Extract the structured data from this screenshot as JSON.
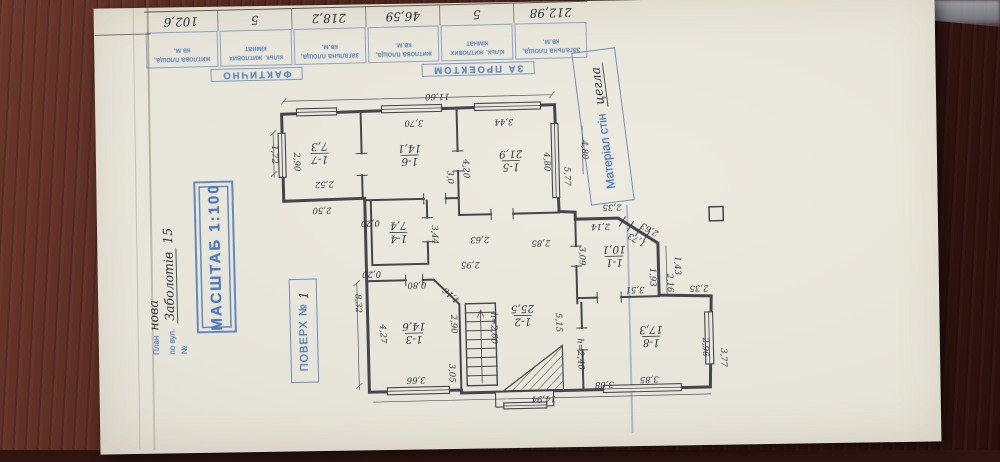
{
  "table": {
    "groups": [
      {
        "label": "ЗА ПРОЕКТОМ"
      },
      {
        "label": "ФАКТИЧНО"
      }
    ],
    "cells": [
      {
        "header": "загальна площа, кв.м.",
        "value": "212,98"
      },
      {
        "header": "кільк. житлових кімнат",
        "value": "5"
      },
      {
        "header": "житлова площа, кв.м.",
        "value": "46,59"
      },
      {
        "header": "загальна площа, кв.м.",
        "value": "218,2"
      },
      {
        "header": "кільк. житлових кімнат",
        "value": "5"
      },
      {
        "header": "житлова площа, кв.м.",
        "value": "102,6"
      }
    ]
  },
  "stamps": {
    "scale_label": "МАСШТАБ 1:100",
    "floor_label": "ПОВЕРХ №",
    "floor_value": "1",
    "material_label": "Матеріал стін",
    "material_value": "цегла",
    "address": {
      "l1": "План",
      "v1": "нова",
      "l2": "по вул.",
      "v2": "Заболотів",
      "l3": "№",
      "v3": "15"
    }
  },
  "plan": {
    "rooms": [
      {
        "number": "1-7",
        "area": "7,3",
        "x": 322,
        "y": 149
      },
      {
        "number": "1-6",
        "area": "14,1",
        "x": 412,
        "y": 153
      },
      {
        "number": "1-5",
        "area": "21,9",
        "x": 513,
        "y": 161
      },
      {
        "number": "1-4",
        "area": "7,4",
        "x": 399,
        "y": 230
      },
      {
        "number": "1-3",
        "area": "14,6",
        "x": 412,
        "y": 331
      },
      {
        "number": "1-2",
        "area": "25,5",
        "x": 521,
        "y": 316
      },
      {
        "number": "1-1",
        "area": "10,1",
        "x": 614,
        "y": 259
      },
      {
        "number": "1-8",
        "area": "17,3",
        "x": 649,
        "y": 340
      }
    ],
    "dimensions": [
      {
        "t": "11,60",
        "x": 441,
        "y": 95,
        "r": 180
      },
      {
        "t": "3,70",
        "x": 417,
        "y": 121,
        "r": 180
      },
      {
        "t": "3,44",
        "x": 507,
        "y": 122,
        "r": 180
      },
      {
        "t": "4,20",
        "x": 468,
        "y": 168,
        "r": 90
      },
      {
        "t": "4,80",
        "x": 549,
        "y": 163,
        "r": 90
      },
      {
        "t": "5,77",
        "x": 569,
        "y": 178,
        "r": 90
      },
      {
        "t": "4,80",
        "x": 587,
        "y": 152,
        "r": 90
      },
      {
        "t": "1,72",
        "x": 277,
        "y": 149,
        "r": 90
      },
      {
        "t": "2,90",
        "x": 299,
        "y": 157,
        "r": 90
      },
      {
        "t": "2,52",
        "x": 326,
        "y": 180,
        "r": 180
      },
      {
        "t": "2,50",
        "x": 323,
        "y": 206,
        "r": 180
      },
      {
        "t": "3,0",
        "x": 452,
        "y": 176,
        "r": 90
      },
      {
        "t": "0,20",
        "x": 371,
        "y": 220,
        "r": 180
      },
      {
        "t": "0,20",
        "x": 371,
        "y": 271,
        "r": 180
      },
      {
        "t": "3,44",
        "x": 435,
        "y": 233,
        "r": 90
      },
      {
        "t": "2,63",
        "x": 480,
        "y": 239,
        "r": 180
      },
      {
        "t": "2,95",
        "x": 470,
        "y": 264,
        "r": 180
      },
      {
        "t": "0,80",
        "x": 416,
        "y": 283,
        "r": 180
      },
      {
        "t": "1,16",
        "x": 450,
        "y": 294,
        "r": 225
      },
      {
        "t": "4,27",
        "x": 381,
        "y": 331,
        "r": 90
      },
      {
        "t": "2,90",
        "x": 452,
        "y": 323,
        "r": 90
      },
      {
        "t": "3,66",
        "x": 413,
        "y": 378,
        "r": 180
      },
      {
        "t": "8,32",
        "x": 357,
        "y": 300,
        "r": 90
      },
      {
        "t": "3,05",
        "x": 449,
        "y": 372,
        "r": 90
      },
      {
        "t": "h=2,60",
        "x": 492,
        "y": 328,
        "r": 90
      },
      {
        "t": "14,94",
        "x": 540,
        "y": 400,
        "r": 180
      },
      {
        "t": "2,85",
        "x": 541,
        "y": 244,
        "r": 180
      },
      {
        "t": "2,14",
        "x": 601,
        "y": 229,
        "r": 180
      },
      {
        "t": "2,35",
        "x": 613,
        "y": 210,
        "r": 180
      },
      {
        "t": "2,63",
        "x": 650,
        "y": 233,
        "r": 212
      },
      {
        "t": "1,73",
        "x": 637,
        "y": 243,
        "r": 212
      },
      {
        "t": "3,09",
        "x": 582,
        "y": 258,
        "r": 90
      },
      {
        "t": "1,93",
        "x": 652,
        "y": 281,
        "r": 90
      },
      {
        "t": "2,16",
        "x": 669,
        "y": 287,
        "r": 90
      },
      {
        "t": "1,43",
        "x": 677,
        "y": 270,
        "r": 90
      },
      {
        "t": "3,51",
        "x": 634,
        "y": 293,
        "r": 180
      },
      {
        "t": "2,35",
        "x": 698,
        "y": 293,
        "r": 180
      },
      {
        "t": "5,15",
        "x": 557,
        "y": 324,
        "r": 90
      },
      {
        "t": "h=2,40",
        "x": 578,
        "y": 356,
        "r": 90
      },
      {
        "t": "2,96",
        "x": 703,
        "y": 352,
        "r": 90
      },
      {
        "t": "3,85",
        "x": 646,
        "y": 383,
        "r": 180
      },
      {
        "t": "3,08",
        "x": 601,
        "y": 387,
        "r": 180
      },
      {
        "t": "3,77",
        "x": 721,
        "y": 363,
        "r": 90
      }
    ]
  }
}
